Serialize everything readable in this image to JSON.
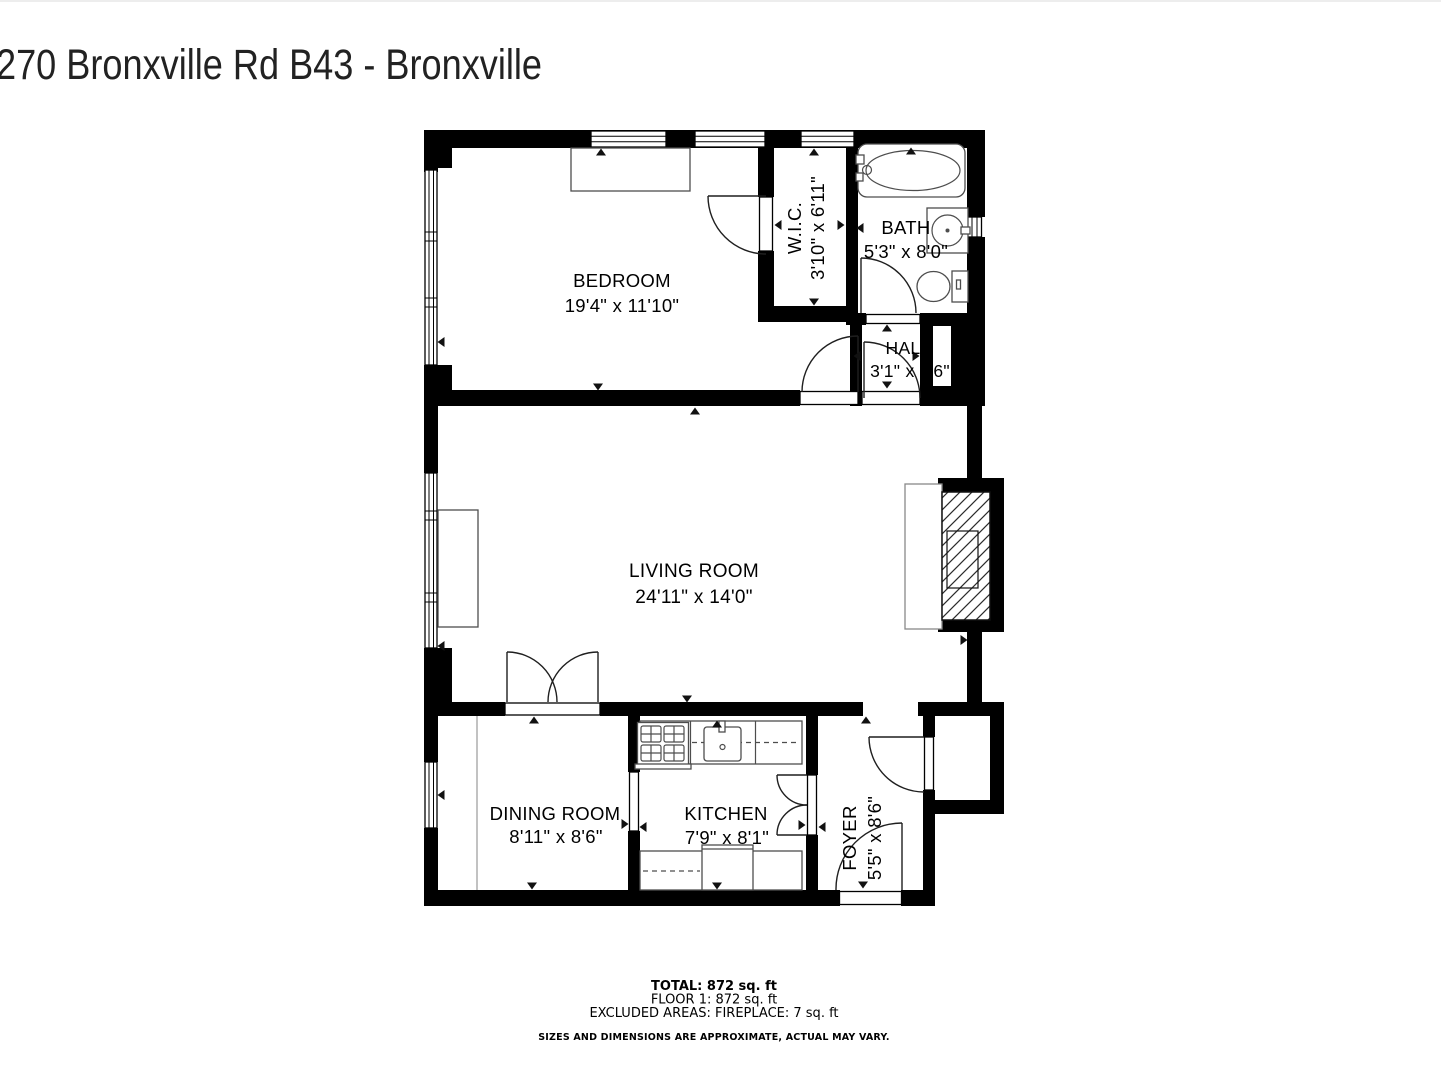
{
  "title": "270 Bronxville Rd B43 - Bronxville",
  "rooms": {
    "bedroom": {
      "name": "BEDROOM",
      "dims": "19'4\" x 11'10\""
    },
    "wic": {
      "name": "W.I.C.",
      "dims": "3'10\" x 6'11\""
    },
    "bath": {
      "name": "BATH",
      "dims": "5'3\" x 8'0\""
    },
    "hall": {
      "name": "HALL",
      "dims": "3'1\" x 3'6\""
    },
    "living": {
      "name": "LIVING ROOM",
      "dims": "24'11\" x 14'0\""
    },
    "dining": {
      "name": "DINING ROOM",
      "dims": "8'11\" x 8'6\""
    },
    "kitchen": {
      "name": "KITCHEN",
      "dims": "7'9\" x 8'1\""
    },
    "foyer": {
      "name": "FOYER",
      "dims": "5'5\" x 8'6\""
    }
  },
  "summary": {
    "total": "TOTAL: 872 sq. ft",
    "floor": "FLOOR 1: 872 sq. ft",
    "excluded": "EXCLUDED AREAS: FIREPLACE: 7 sq. ft",
    "disclaimer": "SIZES AND DIMENSIONS ARE APPROXIMATE, ACTUAL MAY VARY."
  },
  "colors": {
    "wall": "#000000",
    "fixture": "#4d4d4d",
    "background": "#ffffff"
  }
}
